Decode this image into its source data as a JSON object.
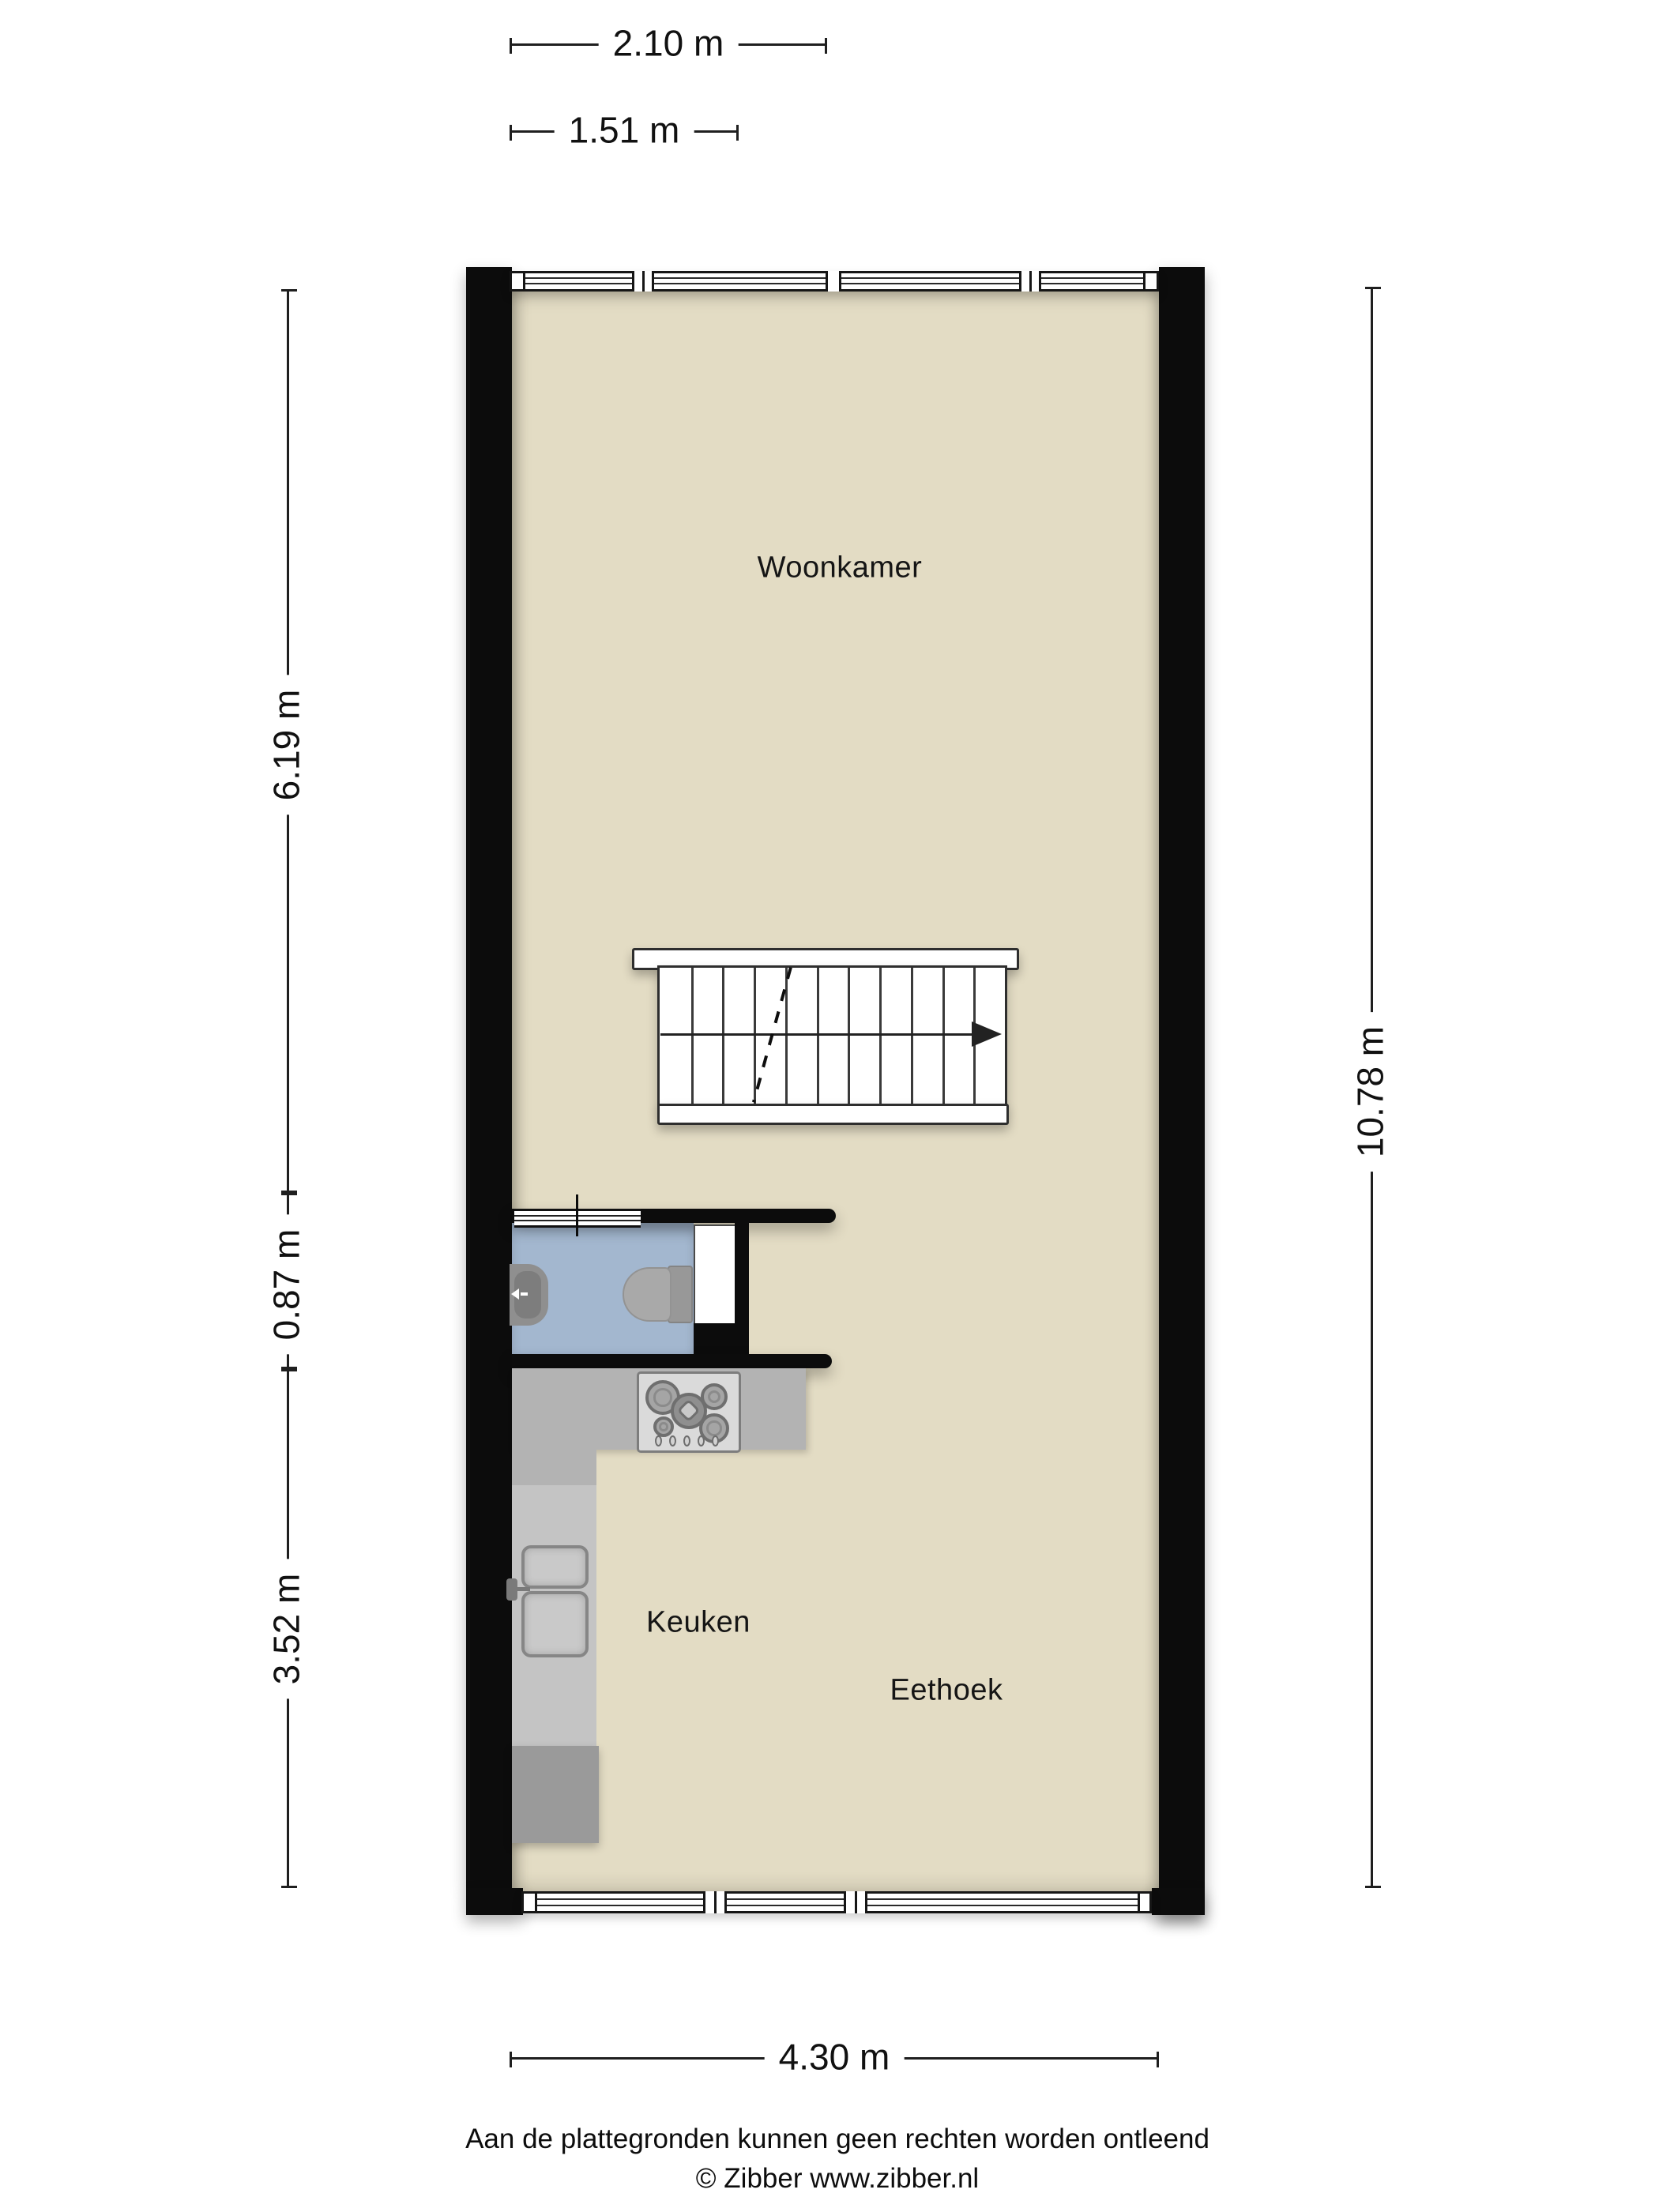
{
  "dimensions": {
    "top_outer": "2.10 m",
    "top_inner": "1.51 m",
    "left_upper": "6.19 m",
    "left_middle": "0.87 m",
    "left_lower": "3.52 m",
    "right_full": "10.78 m",
    "bottom": "4.30 m"
  },
  "rooms": {
    "living": "Woonkamer",
    "kitchen": "Keuken",
    "dining": "Eethoek"
  },
  "footer": {
    "disclaimer": "Aan de plattegronden kunnen geen rechten worden ontleend",
    "copyright": "© Zibber www.zibber.nl"
  },
  "staircase": {
    "tread_lines": 10,
    "direction": "right"
  },
  "colors": {
    "wall": "#0c0c0c",
    "floor": "#e3dcc4",
    "toilet_floor": "#a3b7cf",
    "counter": "#b3b3b3",
    "counter_light": "#c4c4c4",
    "cabinet_dark": "#9a9a9a",
    "dim_line": "#1f1f1f"
  }
}
